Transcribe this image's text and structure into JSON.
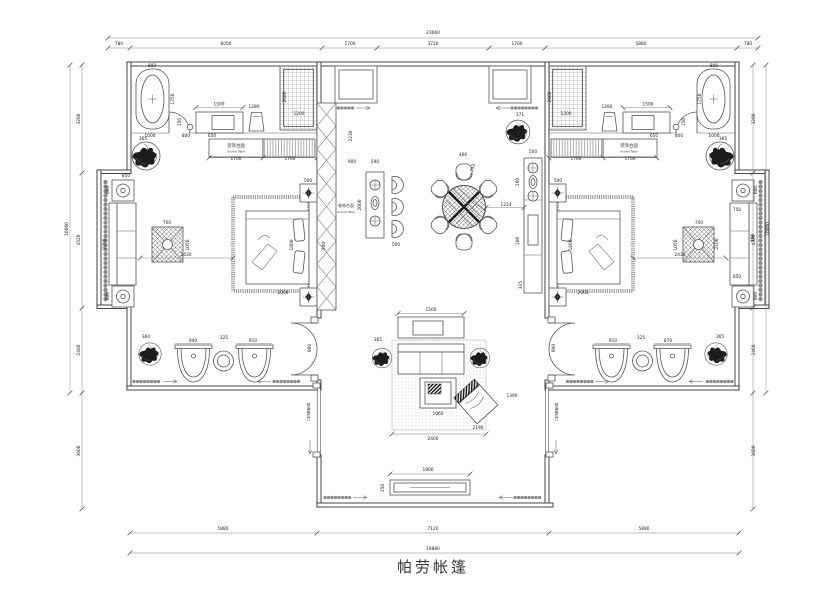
{
  "title": "帕劳帐篷",
  "colors": {
    "ink": "#2a2a2a",
    "line": "#555555",
    "light": "#9a9a9a",
    "bg": "#ffffff"
  },
  "plan_labels": [
    {
      "x": 236,
      "y": 147,
      "t": "装饰台面",
      "s": 4.4
    },
    {
      "x": 236,
      "y": 152.5,
      "t": "Accent Table",
      "s": 2.8
    },
    {
      "x": 629,
      "y": 147,
      "t": "装饰台面",
      "s": 4.4
    },
    {
      "x": 629,
      "y": 152.5,
      "t": "Accent Table",
      "s": 2.8
    },
    {
      "x": 346,
      "y": 207,
      "t": "装饰台面",
      "s": 4.0
    },
    {
      "x": 346,
      "y": 213,
      "t": "Accent Table",
      "s": 2.8
    },
    {
      "x": 309,
      "y": 412,
      "t": "玻璃推拉门",
      "s": 3.6,
      "v": true
    },
    {
      "x": 557,
      "y": 412,
      "t": "玻璃推拉门",
      "s": 3.6,
      "v": true
    }
  ],
  "dimensions": [
    {
      "x": 433,
      "y": 34,
      "t": "23660"
    },
    {
      "x": 119,
      "y": 45,
      "t": "780"
    },
    {
      "x": 226,
      "y": 45,
      "t": "6000"
    },
    {
      "x": 350,
      "y": 45,
      "t": "1700"
    },
    {
      "x": 433,
      "y": 45,
      "t": "3720"
    },
    {
      "x": 517,
      "y": 45,
      "t": "1700"
    },
    {
      "x": 641,
      "y": 45,
      "t": "5880"
    },
    {
      "x": 748,
      "y": 45,
      "t": "780"
    },
    {
      "x": 223,
      "y": 530,
      "t": "5880"
    },
    {
      "x": 433,
      "y": 530,
      "t": "7120"
    },
    {
      "x": 644,
      "y": 530,
      "t": "5880"
    },
    {
      "x": 433,
      "y": 550,
      "t": "18880"
    },
    {
      "x": 68,
      "y": 229,
      "t": "10060",
      "r": -90
    },
    {
      "x": 80,
      "y": 119,
      "t": "3280",
      "r": -90
    },
    {
      "x": 80,
      "y": 240,
      "t": "4320",
      "r": -90
    },
    {
      "x": 80,
      "y": 350,
      "t": "2460",
      "r": -90
    },
    {
      "x": 80,
      "y": 451,
      "t": "3600",
      "r": -90
    },
    {
      "x": 769,
      "y": 229,
      "t": "10060",
      "r": -90
    },
    {
      "x": 755,
      "y": 119,
      "t": "3280",
      "r": -90
    },
    {
      "x": 755,
      "y": 240,
      "t": "4320",
      "r": -90
    },
    {
      "x": 755,
      "y": 350,
      "t": "2460",
      "r": -90
    },
    {
      "x": 755,
      "y": 451,
      "t": "3600",
      "r": -90
    },
    {
      "x": 152,
      "y": 67,
      "t": "800"
    },
    {
      "x": 174,
      "y": 99,
      "t": "1750",
      "r": -90
    },
    {
      "x": 219,
      "y": 105.5,
      "t": "1500"
    },
    {
      "x": 254,
      "y": 108,
      "t": "1280"
    },
    {
      "x": 286,
      "y": 97,
      "t": "2680",
      "r": -90
    },
    {
      "x": 299,
      "y": 115,
      "t": "1200"
    },
    {
      "x": 181,
      "y": 122,
      "t": "150",
      "r": -90
    },
    {
      "x": 150,
      "y": 137,
      "t": "1000"
    },
    {
      "x": 186,
      "y": 137,
      "t": "800"
    },
    {
      "x": 212,
      "y": 137,
      "t": "650"
    },
    {
      "x": 236,
      "y": 160,
      "t": "1700"
    },
    {
      "x": 290,
      "y": 160,
      "t": "1700"
    },
    {
      "x": 143,
      "y": 140,
      "t": "365"
    },
    {
      "x": 186,
      "y": 256,
      "t": "2430"
    },
    {
      "x": 293,
      "y": 245,
      "t": "1800",
      "r": -90
    },
    {
      "x": 283,
      "y": 294,
      "t": "2000"
    },
    {
      "x": 308,
      "y": 182,
      "t": "500"
    },
    {
      "x": 167,
      "y": 224,
      "t": "700"
    },
    {
      "x": 189,
      "y": 245,
      "t": "1050",
      "r": -90
    },
    {
      "x": 106,
      "y": 244,
      "t": "2700",
      "r": -90
    },
    {
      "x": 126,
      "y": 177,
      "t": "850"
    },
    {
      "x": 109,
      "y": 190,
      "t": "600",
      "r": -90
    },
    {
      "x": 109,
      "y": 296,
      "t": "600",
      "r": -90
    },
    {
      "x": 146,
      "y": 338,
      "t": "360"
    },
    {
      "x": 193,
      "y": 342,
      "t": "940"
    },
    {
      "x": 253,
      "y": 342,
      "t": "910"
    },
    {
      "x": 224,
      "y": 339,
      "t": "325"
    },
    {
      "x": 311,
      "y": 348,
      "t": "900",
      "r": -90
    },
    {
      "x": 714,
      "y": 67,
      "t": "800"
    },
    {
      "x": 701,
      "y": 99,
      "t": "1750",
      "r": -90
    },
    {
      "x": 648,
      "y": 105.5,
      "t": "1500"
    },
    {
      "x": 607,
      "y": 108,
      "t": "1280"
    },
    {
      "x": 551,
      "y": 97,
      "t": "2680",
      "r": -90
    },
    {
      "x": 566,
      "y": 115,
      "t": "1200"
    },
    {
      "x": 685,
      "y": 122,
      "t": "150",
      "r": -90
    },
    {
      "x": 714,
      "y": 137,
      "t": "1000"
    },
    {
      "x": 679,
      "y": 137,
      "t": "800"
    },
    {
      "x": 654,
      "y": 137,
      "t": "650"
    },
    {
      "x": 576,
      "y": 160,
      "t": "1700"
    },
    {
      "x": 630,
      "y": 160,
      "t": "1700"
    },
    {
      "x": 723,
      "y": 140,
      "t": "365"
    },
    {
      "x": 680,
      "y": 256,
      "t": "2430"
    },
    {
      "x": 572,
      "y": 245,
      "t": "1800",
      "r": -90
    },
    {
      "x": 583,
      "y": 294,
      "t": "2000"
    },
    {
      "x": 558,
      "y": 182,
      "t": "500"
    },
    {
      "x": 699,
      "y": 224,
      "t": "700"
    },
    {
      "x": 677,
      "y": 245,
      "t": "1050",
      "r": -90
    },
    {
      "x": 718,
      "y": 244,
      "t": "2100",
      "r": -90
    },
    {
      "x": 737,
      "y": 211,
      "t": "750"
    },
    {
      "x": 737,
      "y": 278,
      "t": "850"
    },
    {
      "x": 754,
      "y": 238,
      "t": "400",
      "r": -90
    },
    {
      "x": 757,
      "y": 190,
      "t": "600",
      "r": -90
    },
    {
      "x": 757,
      "y": 296,
      "t": "600",
      "r": -90
    },
    {
      "x": 720,
      "y": 338,
      "t": "365"
    },
    {
      "x": 613,
      "y": 342,
      "t": "910"
    },
    {
      "x": 668,
      "y": 342,
      "t": "870"
    },
    {
      "x": 641,
      "y": 339,
      "t": "325"
    },
    {
      "x": 555,
      "y": 348,
      "t": "900",
      "r": -90
    },
    {
      "x": 352,
      "y": 136,
      "t": "2230",
      "r": -90
    },
    {
      "x": 352,
      "y": 163,
      "t": "900"
    },
    {
      "x": 375,
      "y": 163,
      "t": "590"
    },
    {
      "x": 361,
      "y": 205,
      "t": "2000",
      "r": -90
    },
    {
      "x": 325,
      "y": 246,
      "t": "500",
      "r": -90
    },
    {
      "x": 396,
      "y": 246,
      "t": "500"
    },
    {
      "x": 463,
      "y": 156,
      "t": "466"
    },
    {
      "x": 474,
      "y": 168,
      "t": "752",
      "r": -78
    },
    {
      "x": 506,
      "y": 206,
      "t": "1224"
    },
    {
      "x": 520,
      "y": 116,
      "t": "371"
    },
    {
      "x": 533,
      "y": 153,
      "t": "500"
    },
    {
      "x": 519,
      "y": 182,
      "t": "160",
      "r": -90
    },
    {
      "x": 519,
      "y": 241,
      "t": "160",
      "r": -90
    },
    {
      "x": 522,
      "y": 285,
      "t": "325",
      "r": -90
    },
    {
      "x": 431,
      "y": 311,
      "t": "1500"
    },
    {
      "x": 438,
      "y": 415,
      "t": "1060"
    },
    {
      "x": 433,
      "y": 440,
      "t": "2400"
    },
    {
      "x": 478,
      "y": 429,
      "t": "2190"
    },
    {
      "x": 512,
      "y": 397,
      "t": "1390"
    },
    {
      "x": 428,
      "y": 471,
      "t": "1800"
    },
    {
      "x": 384,
      "y": 488,
      "t": "350",
      "r": -90
    },
    {
      "x": 378,
      "y": 341,
      "t": "365"
    }
  ]
}
